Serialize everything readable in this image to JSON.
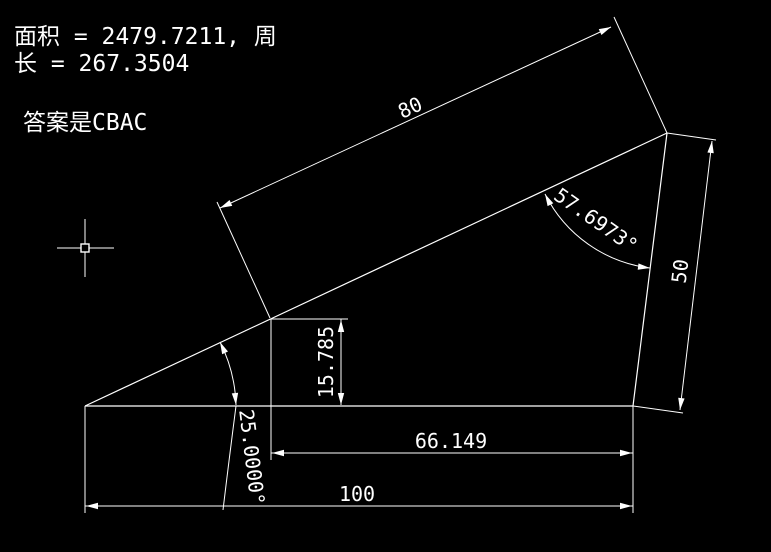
{
  "app": {
    "type": "cad-drawing-area",
    "background_color": "#000000",
    "line_color": "#ffffff"
  },
  "info": {
    "measurement_line1": "面积 = 2479.7211, 周",
    "measurement_line2": "长 = 267.3504",
    "answer_line": "答案是CBAC"
  },
  "dimensions": {
    "hypotenuse_segment": "80",
    "right_side": "50",
    "point_height": "15.785",
    "horizontal_offset": "66.149",
    "base": "100",
    "angle_top": "57.6973°",
    "angle_bottom_left": "25.0000°"
  },
  "shape": {
    "type": "triangle",
    "area": "2479.7211",
    "perimeter": "267.3504",
    "base_length": 100,
    "right_side_length": 50,
    "hypotenuse_marked_segment": 80,
    "angle_at_top_deg": 57.6973,
    "angle_at_bottom_left_deg": 25.0
  },
  "cursor": {
    "kind": "crosshair-with-pickbox"
  }
}
